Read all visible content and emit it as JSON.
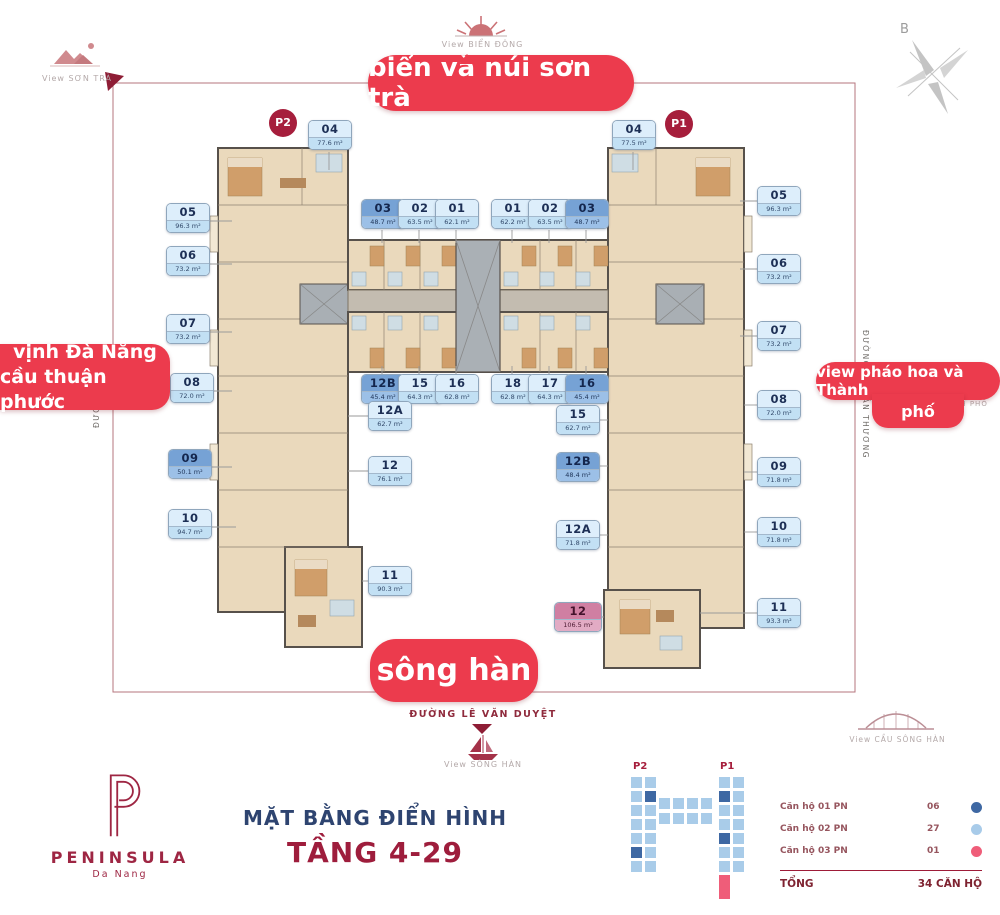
{
  "compass": {
    "label": "B"
  },
  "views": {
    "top": "View BIỂN ĐÔNG",
    "top_left": "View SƠN TRÀ",
    "bottom": "View SÔNG HÀN",
    "bottom_right": "View CẦU SÔNG HÀN",
    "right_partial": "TÂM THÀNH PHỐ"
  },
  "banners": {
    "top": "biển và núi sơn trà",
    "left_line1": "vịnh Đà Nẵng",
    "left_line2": "cầu thuận phước",
    "right_line1": "view pháo hoa và Thành",
    "right_line2": "phố",
    "bottom": "sông hàn"
  },
  "streets": {
    "bottom": "ĐƯỜNG LÊ VĂN DUYỆT",
    "right": "ĐƯỜNG HỒ HÁN THƯƠNG",
    "left": "ĐƯỜNG 1"
  },
  "towers": {
    "left_badge": "P2",
    "right_badge": "P1"
  },
  "units": [
    {
      "id": "04",
      "area": "77.6 m²",
      "variant": "light",
      "tower": "P2",
      "x": 308,
      "y": 120
    },
    {
      "id": "05",
      "area": "96.3 m²",
      "variant": "light",
      "tower": "P2",
      "x": 166,
      "y": 203
    },
    {
      "id": "06",
      "area": "73.2 m²",
      "variant": "light",
      "tower": "P2",
      "x": 166,
      "y": 246
    },
    {
      "id": "07",
      "area": "73.2 m²",
      "variant": "light",
      "tower": "P2",
      "x": 166,
      "y": 314
    },
    {
      "id": "08",
      "area": "72.0 m²",
      "variant": "light",
      "tower": "P2",
      "x": 170,
      "y": 373
    },
    {
      "id": "09",
      "area": "50.1 m²",
      "variant": "dark",
      "tower": "P2",
      "x": 168,
      "y": 449
    },
    {
      "id": "10",
      "area": "94.7 m²",
      "variant": "light",
      "tower": "P2",
      "x": 168,
      "y": 509
    },
    {
      "id": "03",
      "area": "48.7 m²",
      "variant": "dark",
      "tower": "P2",
      "x": 361,
      "y": 199
    },
    {
      "id": "02",
      "area": "63.5 m²",
      "variant": "light",
      "tower": "P2",
      "x": 398,
      "y": 199
    },
    {
      "id": "01",
      "area": "62.1 m²",
      "variant": "light",
      "tower": "P2",
      "x": 435,
      "y": 199
    },
    {
      "id": "12B",
      "area": "45.4 m²",
      "variant": "dark",
      "tower": "P2",
      "x": 361,
      "y": 374
    },
    {
      "id": "15",
      "area": "64.3 m²",
      "variant": "light",
      "tower": "P2",
      "x": 398,
      "y": 374
    },
    {
      "id": "16",
      "area": "62.8 m²",
      "variant": "light",
      "tower": "P2",
      "x": 435,
      "y": 374
    },
    {
      "id": "12A",
      "area": "62.7 m²",
      "variant": "light",
      "tower": "P2",
      "x": 368,
      "y": 401
    },
    {
      "id": "12",
      "area": "76.1 m²",
      "variant": "light",
      "tower": "P2",
      "x": 368,
      "y": 456
    },
    {
      "id": "11",
      "area": "90.3 m²",
      "variant": "light",
      "tower": "P2",
      "x": 368,
      "y": 566
    },
    {
      "id": "01",
      "area": "62.2 m²",
      "variant": "light",
      "tower": "P1",
      "x": 491,
      "y": 199
    },
    {
      "id": "02",
      "area": "63.5 m²",
      "variant": "light",
      "tower": "P1",
      "x": 528,
      "y": 199
    },
    {
      "id": "03",
      "area": "48.7 m²",
      "variant": "dark",
      "tower": "P1",
      "x": 565,
      "y": 199
    },
    {
      "id": "04",
      "area": "77.5 m²",
      "variant": "light",
      "tower": "P1",
      "x": 612,
      "y": 120
    },
    {
      "id": "18",
      "area": "62.8 m²",
      "variant": "light",
      "tower": "P1",
      "x": 491,
      "y": 374
    },
    {
      "id": "17",
      "area": "64.3 m²",
      "variant": "light",
      "tower": "P1",
      "x": 528,
      "y": 374
    },
    {
      "id": "16",
      "area": "45.4 m²",
      "variant": "dark",
      "tower": "P1",
      "x": 565,
      "y": 374
    },
    {
      "id": "15",
      "area": "62.7 m²",
      "variant": "light",
      "tower": "P1",
      "x": 556,
      "y": 405
    },
    {
      "id": "12B",
      "area": "48.4 m²",
      "variant": "dark",
      "tower": "P1",
      "x": 556,
      "y": 452
    },
    {
      "id": "12A",
      "area": "71.8 m²",
      "variant": "light",
      "tower": "P1",
      "x": 556,
      "y": 520
    },
    {
      "id": "12",
      "area": "106.5 m²",
      "variant": "pink",
      "tower": "P1",
      "x": 554,
      "y": 602,
      "w": 46
    },
    {
      "id": "05",
      "area": "96.3 m²",
      "variant": "light",
      "tower": "P1",
      "x": 757,
      "y": 186
    },
    {
      "id": "06",
      "area": "73.2 m²",
      "variant": "light",
      "tower": "P1",
      "x": 757,
      "y": 254
    },
    {
      "id": "07",
      "area": "73.2 m²",
      "variant": "light",
      "tower": "P1",
      "x": 757,
      "y": 321
    },
    {
      "id": "08",
      "area": "72.0 m²",
      "variant": "light",
      "tower": "P1",
      "x": 757,
      "y": 390
    },
    {
      "id": "09",
      "area": "71.8 m²",
      "variant": "light",
      "tower": "P1",
      "x": 757,
      "y": 457
    },
    {
      "id": "10",
      "area": "71.8 m²",
      "variant": "light",
      "tower": "P1",
      "x": 757,
      "y": 517
    },
    {
      "id": "11",
      "area": "93.3 m²",
      "variant": "light",
      "tower": "P1",
      "x": 757,
      "y": 598
    }
  ],
  "minimap": {
    "p2": "P2",
    "p1": "P1",
    "cells": [
      {
        "x": 630,
        "y": 776,
        "variant": "light"
      },
      {
        "x": 630,
        "y": 790,
        "variant": "light"
      },
      {
        "x": 630,
        "y": 804,
        "variant": "light"
      },
      {
        "x": 630,
        "y": 818,
        "variant": "light"
      },
      {
        "x": 630,
        "y": 832,
        "variant": "light"
      },
      {
        "x": 630,
        "y": 846,
        "variant": "dark"
      },
      {
        "x": 630,
        "y": 860,
        "variant": "light"
      },
      {
        "x": 644,
        "y": 776,
        "variant": "light"
      },
      {
        "x": 644,
        "y": 790,
        "variant": "dark"
      },
      {
        "x": 644,
        "y": 804,
        "variant": "light"
      },
      {
        "x": 644,
        "y": 818,
        "variant": "light"
      },
      {
        "x": 644,
        "y": 832,
        "variant": "light"
      },
      {
        "x": 644,
        "y": 846,
        "variant": "light"
      },
      {
        "x": 644,
        "y": 860,
        "variant": "light"
      },
      {
        "x": 658,
        "y": 797,
        "variant": "light"
      },
      {
        "x": 672,
        "y": 797,
        "variant": "light"
      },
      {
        "x": 686,
        "y": 797,
        "variant": "light"
      },
      {
        "x": 700,
        "y": 797,
        "variant": "light"
      },
      {
        "x": 658,
        "y": 812,
        "variant": "light"
      },
      {
        "x": 672,
        "y": 812,
        "variant": "light"
      },
      {
        "x": 686,
        "y": 812,
        "variant": "light"
      },
      {
        "x": 700,
        "y": 812,
        "variant": "light"
      },
      {
        "x": 718,
        "y": 776,
        "variant": "light"
      },
      {
        "x": 718,
        "y": 790,
        "variant": "dark"
      },
      {
        "x": 718,
        "y": 804,
        "variant": "light"
      },
      {
        "x": 718,
        "y": 818,
        "variant": "light"
      },
      {
        "x": 718,
        "y": 832,
        "variant": "dark"
      },
      {
        "x": 718,
        "y": 846,
        "variant": "light"
      },
      {
        "x": 718,
        "y": 860,
        "variant": "light"
      },
      {
        "x": 718,
        "y": 874,
        "variant": "pink",
        "h": 26
      },
      {
        "x": 732,
        "y": 776,
        "variant": "light"
      },
      {
        "x": 732,
        "y": 790,
        "variant": "light"
      },
      {
        "x": 732,
        "y": 804,
        "variant": "light"
      },
      {
        "x": 732,
        "y": 818,
        "variant": "light"
      },
      {
        "x": 732,
        "y": 832,
        "variant": "light"
      },
      {
        "x": 732,
        "y": 846,
        "variant": "light"
      },
      {
        "x": 732,
        "y": 860,
        "variant": "light"
      }
    ]
  },
  "legend": {
    "rows": [
      {
        "label": "Căn hộ 01 PN",
        "value": "06",
        "variant": "dark"
      },
      {
        "label": "Căn hộ 02 PN",
        "value": "27",
        "variant": "light"
      },
      {
        "label": "Căn hộ 03 PN",
        "value": "01",
        "variant": "pink"
      }
    ],
    "total_label": "TỔNG",
    "total_value": "34 CĂN HỘ"
  },
  "footer": {
    "logo_title": "PENINSULA",
    "logo_subtitle": "Da Nang",
    "plan_title": "MẶT BẰNG ĐIỂN HÌNH",
    "plan_subtitle": "TẦNG 4-29"
  },
  "colors": {
    "accent_red": "#ec3b4d",
    "dark_red": "#9e1b38",
    "navy": "#2e4470",
    "unit_light": "#c2e0f4",
    "unit_dark": "#76a2d5",
    "unit_pink": "#d07fa2"
  }
}
